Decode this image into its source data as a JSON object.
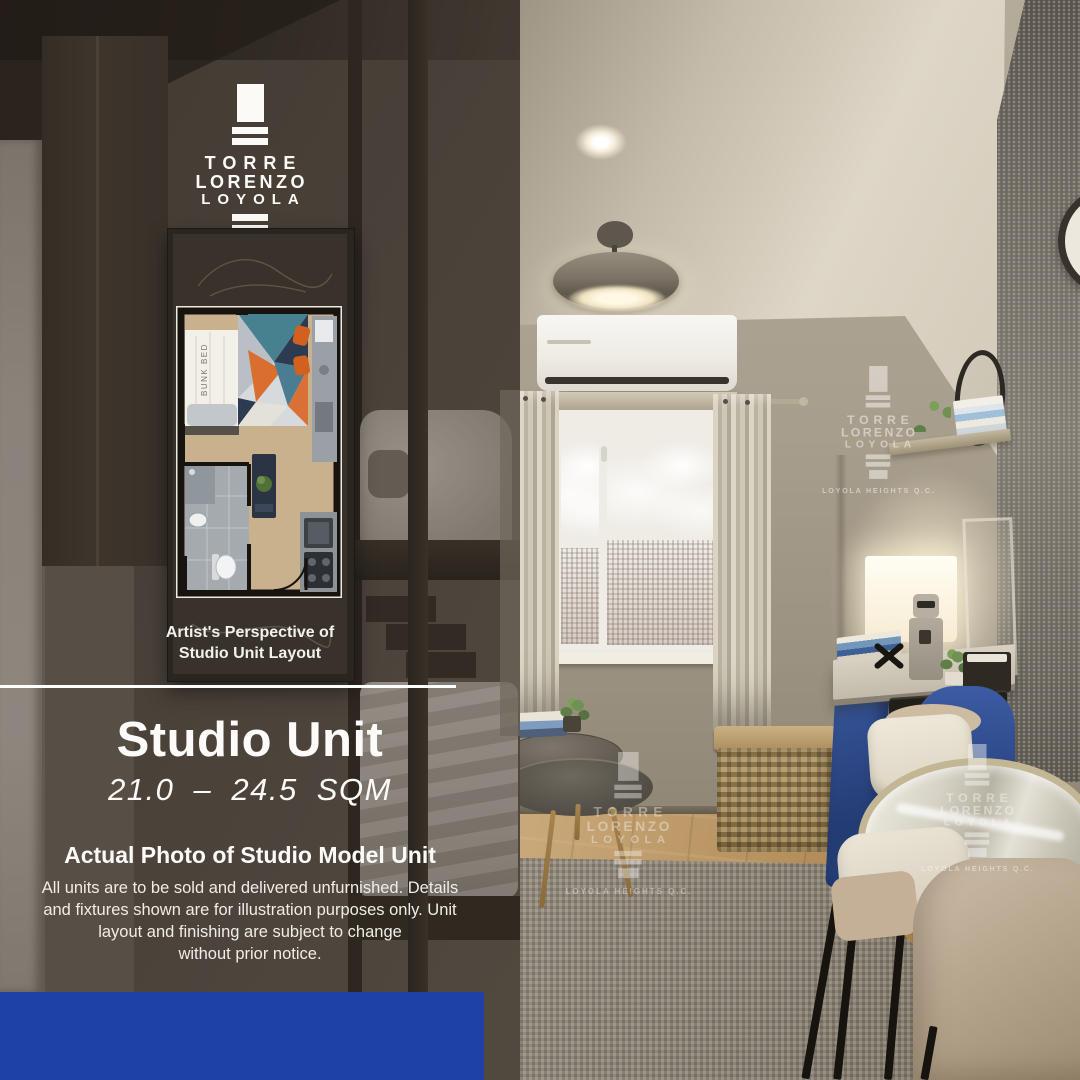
{
  "brand": {
    "name_line1": "TORRE",
    "name_line2": "LORENZO",
    "name_line3": "LOYOLA",
    "location": "LOYOLA HEIGHTS Q.C."
  },
  "floor_plan": {
    "caption_line1": "Artist's Perspective of",
    "caption_line2": "Studio Unit Layout",
    "bed_label": "BUNK BED"
  },
  "unit": {
    "title": "Studio Unit",
    "size_range": "21.0 – 24.5 SQM"
  },
  "model_photo": {
    "heading": "Actual Photo of Studio Model Unit",
    "disclaimer_lines": [
      "All units are to be sold and delivered unfurnished.  Details",
      "and fixtures shown are for illustration purposes only. Unit",
      "layout and finishing are subject to change",
      "without prior notice."
    ]
  },
  "colors": {
    "accent_blue": "#1e41a8",
    "overlay_brown": "#4a423a",
    "plan_orange": "#d96f2e",
    "plan_teal": "#47808e",
    "plan_navy": "#2c3a52"
  }
}
